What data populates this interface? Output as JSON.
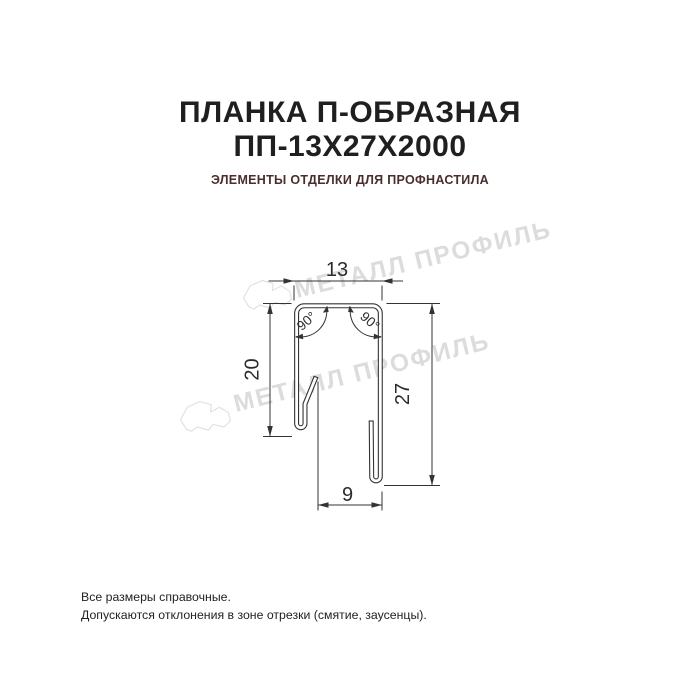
{
  "header": {
    "title_line1": "ПЛАНКА П-ОБРАЗНАЯ",
    "title_line2": "ПП-13Х27Х2000",
    "subtitle": "ЭЛЕМЕНТЫ ОТДЕЛКИ ДЛЯ ПРОФНАСТИЛА"
  },
  "drawing": {
    "dim_top_width": "13",
    "dim_left_height": "20",
    "dim_right_height": "27",
    "dim_bottom_width": "9",
    "angle_top_left": "90°",
    "angle_top_right": "90°"
  },
  "watermark": {
    "text": "МЕТАЛЛ ПРОФИЛЬ"
  },
  "icons": {
    "watermark_logo": "cloud-logo"
  },
  "footer": {
    "line1": "Все размеры справочные.",
    "line2": "Допускаются отклонения в зоне отрезки (смятие, заусенцы)."
  },
  "colors": {
    "title": "#1f1f1f",
    "subtitle": "#4a2e2e",
    "drawing_line": "#333333",
    "watermark": "#dcdcdc",
    "background": "#ffffff"
  }
}
